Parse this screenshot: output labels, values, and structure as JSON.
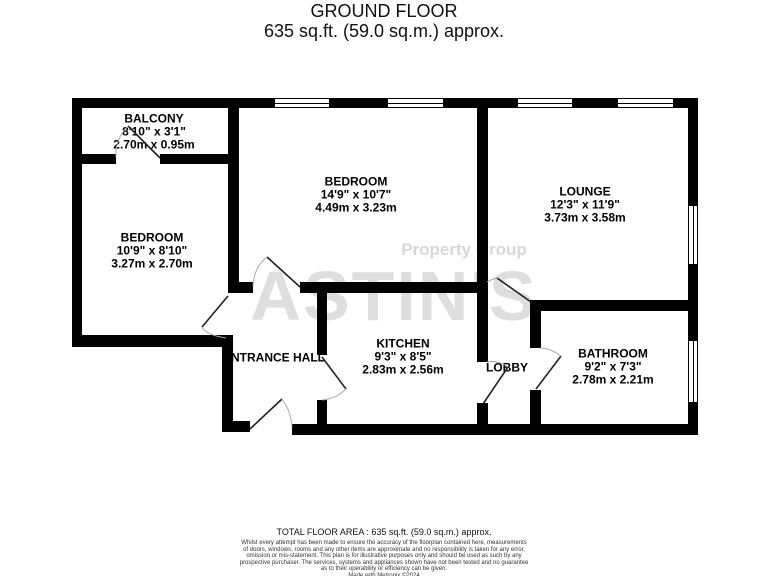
{
  "title": {
    "line1": "GROUND FLOOR",
    "line2": "635 sq.ft. (59.0 sq.m.) approx."
  },
  "watermark": {
    "brand": "ASTIN'S",
    "tagline": "Property Group"
  },
  "rooms": {
    "balcony": {
      "name": "BALCONY",
      "imperial": "8'10\" x 3'1\"",
      "metric": "2.70m x 0.95m"
    },
    "bedroom1": {
      "name": "BEDROOM",
      "imperial": "10'9\" x 8'10\"",
      "metric": "3.27m x 2.70m"
    },
    "bedroom2": {
      "name": "BEDROOM",
      "imperial": "14'9\" x 10'7\"",
      "metric": "4.49m x 3.23m"
    },
    "lounge": {
      "name": "LOUNGE",
      "imperial": "12'3\" x 11'9\"",
      "metric": "3.73m x 3.58m"
    },
    "kitchen": {
      "name": "KITCHEN",
      "imperial": "9'3\" x 8'5\"",
      "metric": "2.83m x 2.56m"
    },
    "entrance_hall": {
      "name": "ENTRANCE HALL"
    },
    "lobby": {
      "name": "LOBBY"
    },
    "bathroom": {
      "name": "BATHROOM",
      "imperial": "9'2\" x 7'3\"",
      "metric": "2.78m x 2.21m"
    }
  },
  "footer": {
    "total_area": "TOTAL FLOOR AREA : 635 sq.ft. (59.0 sq.m.) approx.",
    "disclaimer_lines": [
      "Whilst every attempt has been made to ensure the accuracy of the floorplan contained here, measurements",
      "of doors, windows, rooms and any other items are approximate and no responsibility is taken for any error,",
      "omission or mis-statement. This plan is for illustrative purposes only and should be used as such by any",
      "prospective purchaser. The services, systems and appliances shown have not been tested and no guarantee",
      "as to their operability or efficiency can be given."
    ],
    "credit": "Made with Metropix ©2024"
  },
  "colors": {
    "wall": "#000000",
    "door_leaf": "#222222",
    "door_arc": "#aaaaaa",
    "watermark": "#dedede"
  }
}
